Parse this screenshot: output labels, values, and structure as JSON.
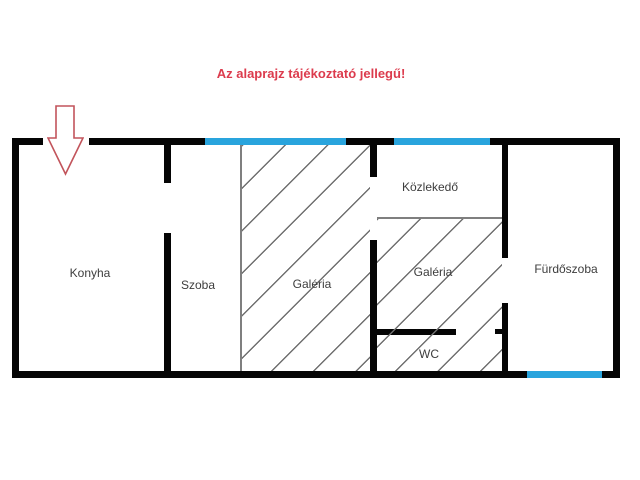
{
  "disclaimer": {
    "text": "Az alaprajz tájékoztató jellegű!",
    "color": "#dc3b4d"
  },
  "floorplan": {
    "rooms": {
      "konyha": {
        "label": "Konyha"
      },
      "szoba": {
        "label": "Szoba"
      },
      "galeria1": {
        "label": "Galéria"
      },
      "kozlekedo": {
        "label": "Közlekedő"
      },
      "galeria2": {
        "label": "Galéria"
      },
      "wc": {
        "label": "WC"
      },
      "furdoszoba": {
        "label": "Fürdőszoba"
      }
    },
    "icons": {
      "entrance_arrow": "down-arrow"
    },
    "colors": {
      "wall": "#050505",
      "window_blue": "#29a4dd",
      "hatch_gray": "#6f6f6f",
      "boundary_gray": "#7f7f7f",
      "label_text": "#3d3d3d",
      "arrow_red": "#c2545b",
      "disclaimer_red": "#dc3b4d"
    }
  }
}
